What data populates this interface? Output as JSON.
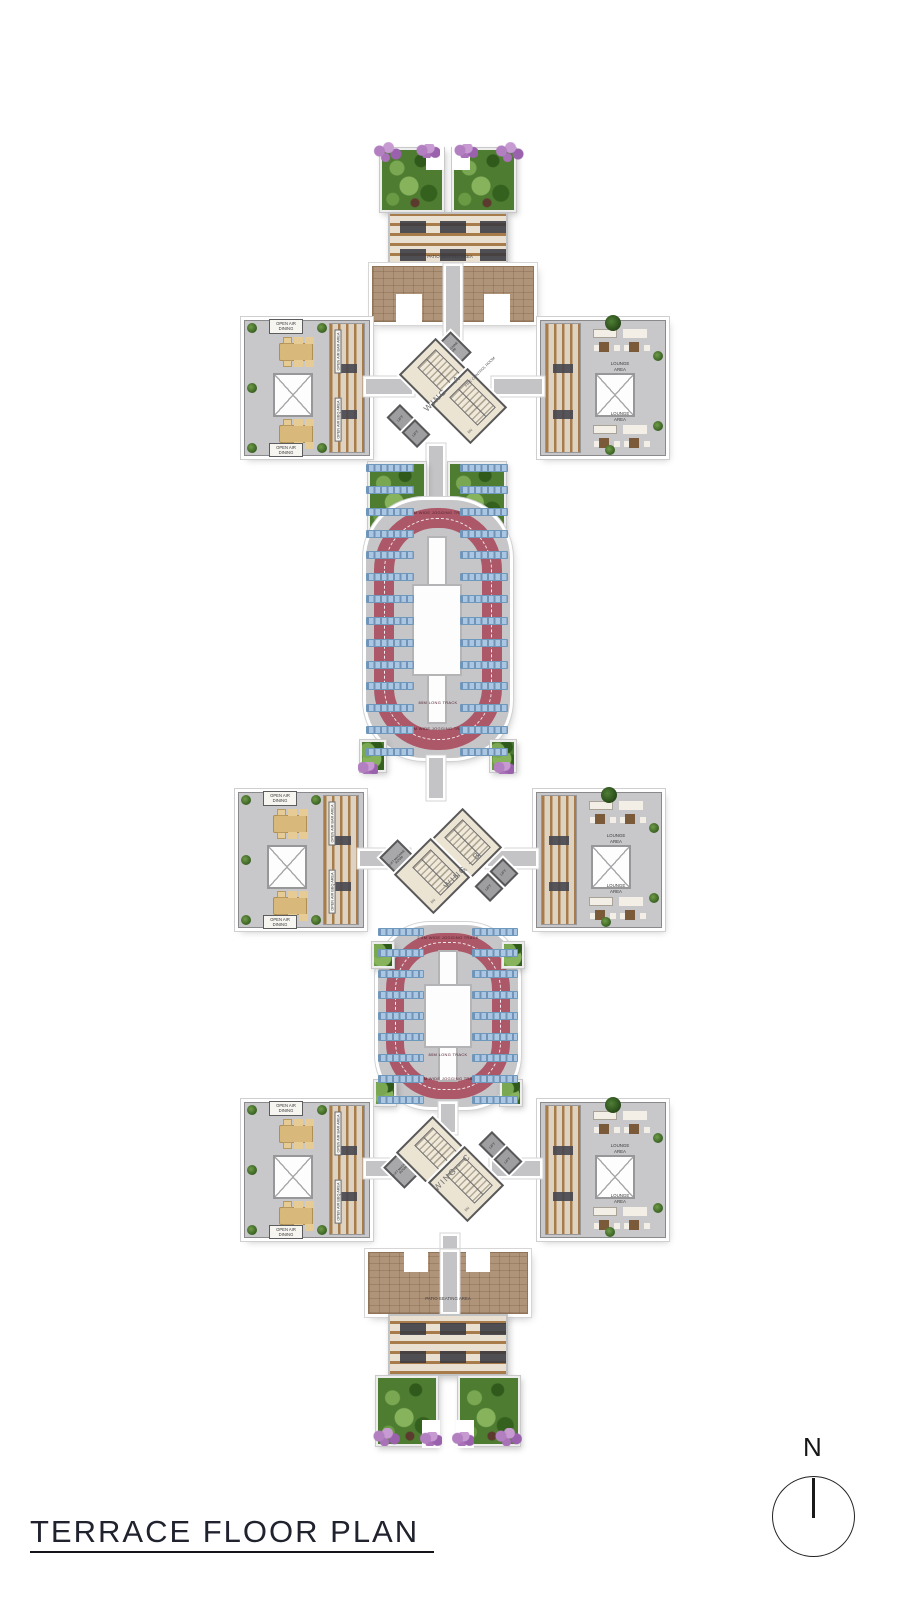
{
  "title": "TERRACE FLOOR PLAN",
  "compass": {
    "north_label": "N"
  },
  "wings": {
    "a": {
      "name": "WING - A"
    },
    "b": {
      "name": "WING - B"
    },
    "c": {
      "name": "WING - C"
    }
  },
  "areas": {
    "patio_seating": "PATIO SEATING AREA",
    "open_air_dining": "OPEN AIR DINING",
    "open_air_bar": "OPEN AIR BAR AREA",
    "open_air_bbq": "OPEN AIR BBQ AREA",
    "lounge": "LOUNGE AREA",
    "lift": "LIFT",
    "down": "DN",
    "fire_control_room": "FIRE CONTROL ROOM",
    "lift_machine_room": "LIFT MACHINE ROOM"
  },
  "track": {
    "length_label": "80M LONG TRACK",
    "width_label": "2.4M WIDE JOGGING TRACK"
  },
  "colors": {
    "terrace_brown": "#b0947a",
    "pergola_wood": "#a87c4a",
    "paving_grey": "#c6c6c8",
    "track_red": "#ad5868",
    "panel_blue": "#a9c6e2",
    "garden_green": "#4e7c30",
    "flower_purple": "#a877b6"
  }
}
